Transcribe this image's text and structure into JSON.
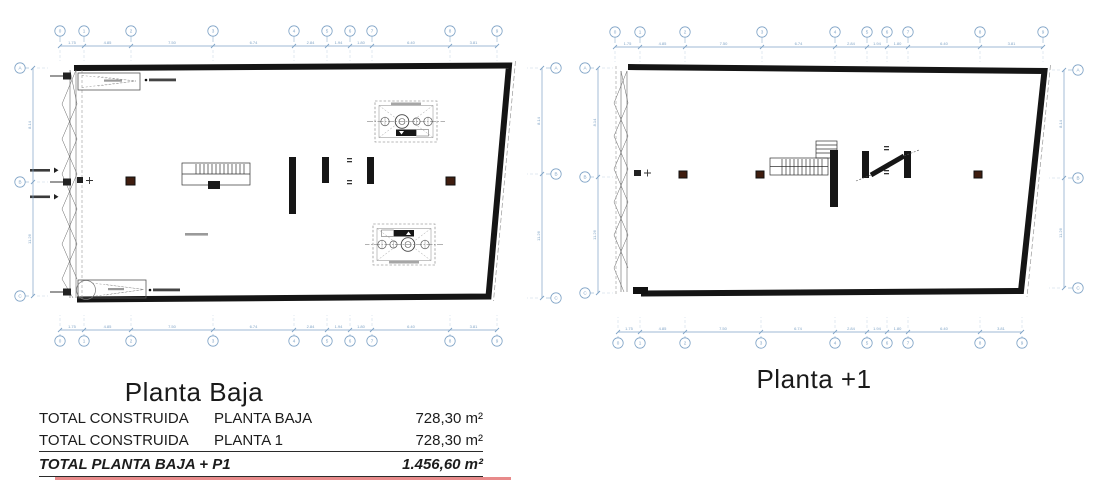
{
  "titles": {
    "left": "Planta Baja",
    "right": "Planta +1"
  },
  "table": {
    "rows": [
      {
        "c1": "TOTAL CONSTRUIDA",
        "c2": "PLANTA BAJA",
        "value": "728,30 m²"
      },
      {
        "c1": "TOTAL CONSTRUIDA",
        "c2": "PLANTA 1",
        "value": "728,30 m²"
      }
    ],
    "total": {
      "label": "TOTAL PLANTA BAJA + P1",
      "value": "1.456,60 m²"
    }
  },
  "colors": {
    "grid": "#7fa3c6",
    "grid_ext": "#bccedf",
    "outline": "#151515",
    "column_fill": "#3f1d0f",
    "detail": "#555555",
    "red_line": "#e88a8a"
  },
  "grids": {
    "planta_baja_top": {
      "xs": [
        60,
        84,
        131,
        213,
        294,
        327,
        350,
        372,
        450,
        497
      ],
      "labels": [
        "0",
        "1",
        "2",
        "3",
        "4",
        "5",
        "6",
        "7",
        "8",
        "9"
      ],
      "dims": [
        "1.75",
        "4.85",
        "7.50",
        "6.74",
        "2.84",
        "1.94",
        "1.80",
        "6.40",
        "3.81"
      ],
      "bubble": 31,
      "line": 46
    },
    "planta_baja_bottom": {
      "xs": [
        60,
        84,
        131,
        213,
        294,
        327,
        350,
        372,
        450,
        497
      ],
      "labels": [
        "0",
        "1",
        "2",
        "3",
        "4",
        "5",
        "6",
        "7",
        "8",
        "9"
      ],
      "dims": [
        "1.75",
        "4.85",
        "7.50",
        "6.74",
        "2.84",
        "1.94",
        "1.80",
        "6.40",
        "3.81"
      ],
      "bubble": 341,
      "line": 330
    },
    "planta_baja_left": {
      "ys": [
        68,
        182,
        296
      ],
      "labels": [
        "A",
        "B",
        "C"
      ],
      "dims": [
        "8.14",
        "11.26"
      ],
      "bubble": 20,
      "line": 33
    },
    "planta_baja_right": {
      "ys": [
        68,
        174,
        298
      ],
      "labels": [
        "A",
        "B",
        "C"
      ],
      "dims": [
        "8.14",
        "11.26"
      ],
      "bubble": 556,
      "line": 542
    },
    "planta_1_top": {
      "xs": [
        615,
        640,
        685,
        762,
        835,
        867,
        887,
        908,
        980,
        1043
      ],
      "labels": [
        "0",
        "1",
        "2",
        "3",
        "4",
        "5",
        "6",
        "7",
        "8",
        "9"
      ],
      "dims": [
        "1.75",
        "4.85",
        "7.50",
        "6.74",
        "2.84",
        "1.94",
        "1.80",
        "6.40",
        "3.81"
      ],
      "bubble": 32,
      "line": 47
    },
    "planta_1_bottom": {
      "xs": [
        618,
        640,
        685,
        761,
        835,
        867,
        887,
        908,
        980,
        1022
      ],
      "labels": [
        "0",
        "1",
        "2",
        "3",
        "4",
        "5",
        "6",
        "7",
        "8",
        "9"
      ],
      "dims": [
        "1.75",
        "4.85",
        "7.50",
        "6.74",
        "2.84",
        "1.94",
        "1.80",
        "6.40",
        "3.81"
      ],
      "bubble": 343,
      "line": 332
    },
    "planta_1_left": {
      "ys": [
        68,
        177,
        293
      ],
      "labels": [
        "A",
        "B",
        "C"
      ],
      "dims": [
        "8.14",
        "11.26"
      ],
      "bubble": 585,
      "line": 598
    },
    "planta_1_right": {
      "ys": [
        70,
        178,
        288
      ],
      "labels": [
        "A",
        "B",
        "C"
      ],
      "dims": [
        "8.14",
        "11.26"
      ],
      "bubble": 1078,
      "line": 1064
    }
  }
}
